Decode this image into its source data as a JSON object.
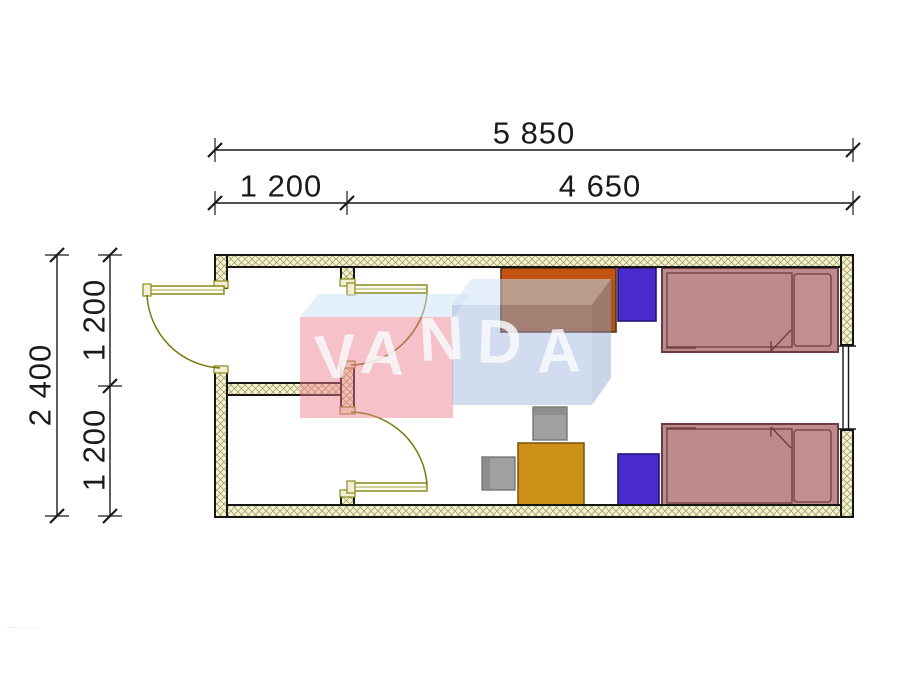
{
  "dimensions": {
    "overall_width": "5 850",
    "entry_width": "1 200",
    "room_width": "4 650",
    "overall_depth": "2 400",
    "upper_depth": "1 200",
    "lower_depth": "1 200"
  },
  "watermark": {
    "name": "VANDA",
    "letters": [
      "V",
      "A",
      "N",
      "D",
      "A"
    ]
  },
  "fine_print": "·········· ···· ··· ·· ··",
  "colors": {
    "wall_fill": "#f7f3da",
    "wall_hatch": "#a3a35a",
    "wall_edge": "#151515",
    "door": "#8a8a1e",
    "bed_fill": "#bd8a8d",
    "bed_edge": "#6f3c41",
    "pillow_fill": "#c29093",
    "nightstand_fill": "#4a2ccd",
    "nightstand_edge": "#241378",
    "wardrobe_fill": "#a9571f",
    "wardrobe_top": "#c25312",
    "table_fill": "#cd9118",
    "chair_fill": "#a0a0a0",
    "dimension_line": "#1a1a1a",
    "watermark_pink": "rgba(236,125,140,0.48)",
    "watermark_blue": "rgba(156,178,220,0.45)",
    "watermark_top_face": "rgba(206,226,246,0.55)",
    "watermark_letters": "#ffffff"
  }
}
